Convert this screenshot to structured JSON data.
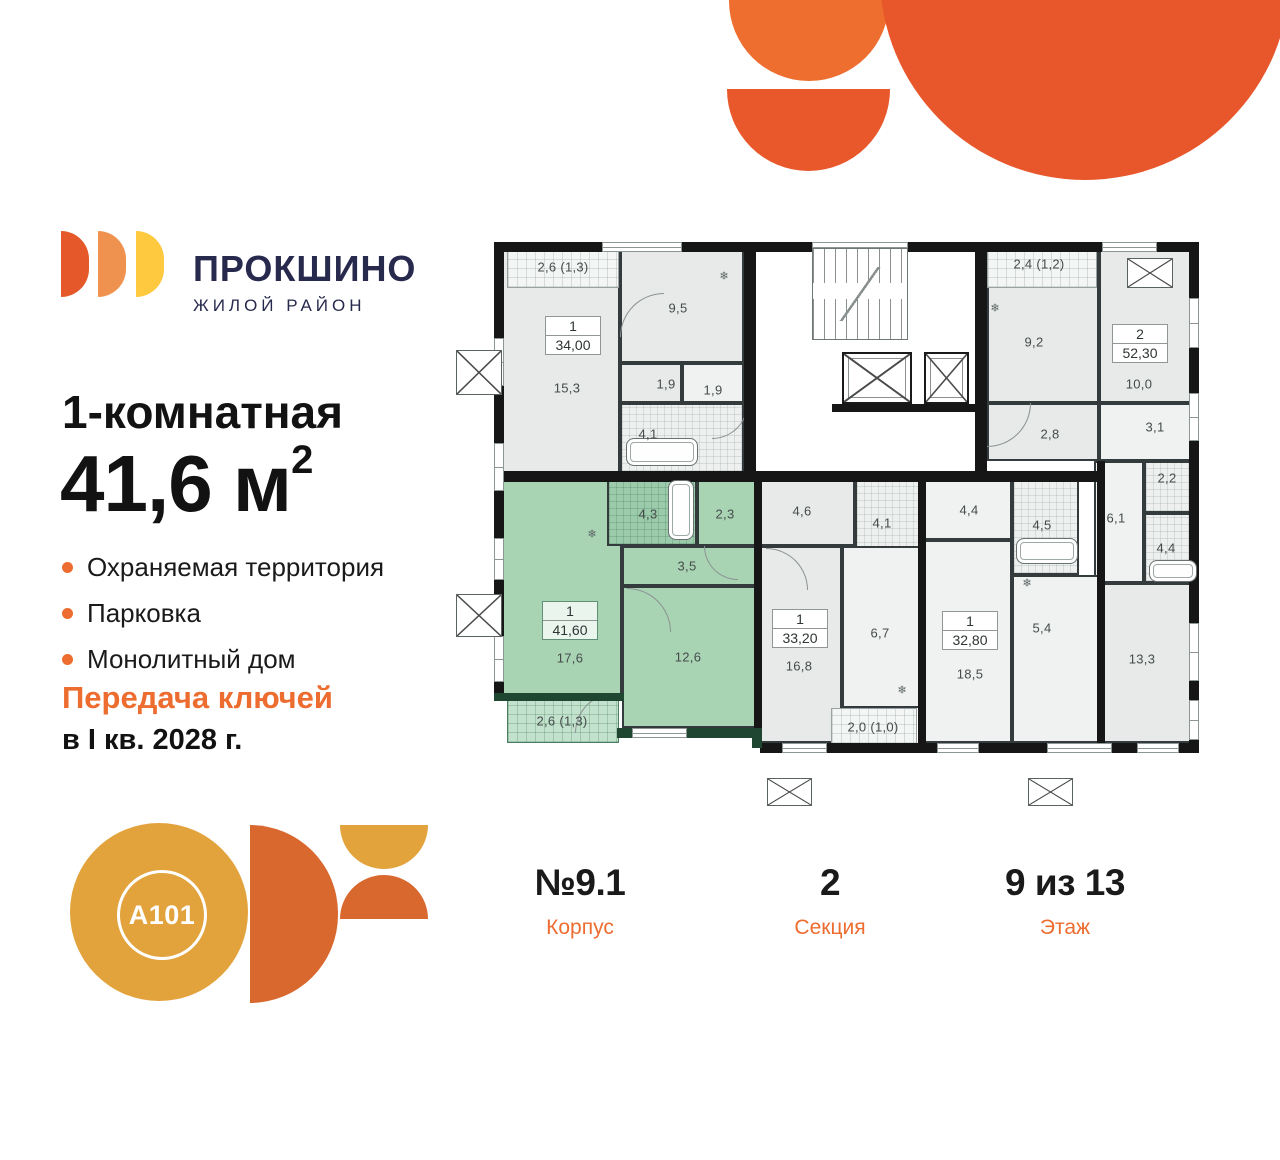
{
  "colors": {
    "accent_orange": "#ED6C2F",
    "deco_orange_light": "#ED6E2E",
    "deco_orange": "#E8572B",
    "navy": "#272A4D",
    "logo_arc1": "#E4582A",
    "logo_arc2": "#F0924F",
    "logo_arc3": "#FFC93F",
    "a101_gold": "#E2A33C",
    "a101_orange": "#D9682F",
    "plan_green": "#A9D4B4"
  },
  "brand": {
    "logo_title": "ПРОКШИНО",
    "logo_subtitle": "ЖИЛОЙ РАЙОН",
    "developer": "A101"
  },
  "offer": {
    "title": "1-комнатная",
    "area_value": "41,6",
    "area_unit": " м",
    "area_sup": "2",
    "features": [
      "Охраняемая территория",
      "Парковка",
      "Монолитный дом"
    ],
    "keys_line1": "Передача ключей",
    "keys_line2": "в I кв. 2028 г."
  },
  "footer": {
    "columns": [
      {
        "value": "№9.1",
        "label": "Корпус"
      },
      {
        "value": "2",
        "label": "Секция"
      },
      {
        "value": "9 из 13",
        "label": "Этаж"
      }
    ]
  },
  "plan": {
    "rooms": [
      [
        "g",
        20,
        12,
        118,
        238
      ],
      [
        "g",
        138,
        12,
        124,
        113
      ],
      [
        "g",
        138,
        125,
        62,
        40
      ],
      [
        "gl",
        200,
        125,
        62,
        40
      ],
      [
        "b",
        138,
        165,
        124,
        70
      ],
      [
        "bal",
        25,
        10,
        112,
        40
      ],
      [
        "g",
        505,
        12,
        112,
        153
      ],
      [
        "g",
        617,
        12,
        100,
        153
      ],
      [
        "g",
        505,
        165,
        112,
        58
      ],
      [
        "gl",
        617,
        165,
        100,
        58
      ],
      [
        "gl",
        612,
        223,
        50,
        122
      ],
      [
        "b",
        662,
        223,
        55,
        52
      ],
      [
        "b",
        662,
        275,
        55,
        70
      ],
      [
        "g",
        617,
        345,
        100,
        160
      ],
      [
        "bal",
        505,
        10,
        110,
        40
      ],
      [
        "gl",
        440,
        240,
        90,
        62
      ],
      [
        "b",
        530,
        240,
        67,
        97
      ],
      [
        "gl",
        440,
        302,
        90,
        203
      ],
      [
        "gl",
        530,
        337,
        88,
        168
      ],
      [
        "g",
        278,
        240,
        95,
        68
      ],
      [
        "b",
        373,
        240,
        67,
        95
      ],
      [
        "g",
        278,
        308,
        82,
        197
      ],
      [
        "gl",
        360,
        308,
        80,
        162
      ],
      [
        "bal",
        349,
        470,
        86,
        36
      ],
      [
        "gr",
        20,
        240,
        120,
        220
      ],
      [
        "bg",
        125,
        240,
        90,
        68
      ],
      [
        "gr",
        215,
        240,
        63,
        68
      ],
      [
        "gr",
        140,
        308,
        138,
        40
      ],
      [
        "gr",
        140,
        348,
        138,
        142
      ],
      [
        "balg",
        25,
        460,
        112,
        45
      ]
    ],
    "walls": [
      [
        12,
        4,
        705,
        10,
        0
      ],
      [
        12,
        4,
        10,
        459,
        0
      ],
      [
        707,
        4,
        10,
        511,
        0
      ],
      [
        262,
        4,
        12,
        236,
        0
      ],
      [
        493,
        4,
        12,
        236,
        0
      ],
      [
        350,
        166,
        143,
        8,
        0
      ],
      [
        12,
        233,
        608,
        11,
        0
      ],
      [
        272,
        240,
        8,
        265,
        0
      ],
      [
        436,
        240,
        8,
        265,
        0
      ],
      [
        615,
        223,
        8,
        282,
        0
      ],
      [
        278,
        505,
        439,
        10,
        0
      ],
      [
        12,
        455,
        130,
        8,
        1
      ],
      [
        135,
        490,
        143,
        10,
        1
      ],
      [
        270,
        490,
        10,
        20,
        1
      ]
    ],
    "windows": [
      [
        12,
        100,
        10,
        48
      ],
      [
        12,
        205,
        10,
        48
      ],
      [
        12,
        300,
        10,
        42
      ],
      [
        12,
        398,
        10,
        46
      ],
      [
        120,
        4,
        80,
        10
      ],
      [
        330,
        4,
        96,
        10
      ],
      [
        620,
        4,
        55,
        10
      ],
      [
        707,
        60,
        10,
        50
      ],
      [
        707,
        155,
        10,
        48
      ],
      [
        707,
        385,
        10,
        58
      ],
      [
        707,
        462,
        10,
        40
      ],
      [
        300,
        505,
        45,
        10
      ],
      [
        455,
        505,
        42,
        10
      ],
      [
        565,
        505,
        65,
        10
      ],
      [
        655,
        505,
        42,
        10
      ],
      [
        150,
        490,
        55,
        10
      ]
    ],
    "texts": [
      [
        "2,6 (1,3)",
        81,
        29
      ],
      [
        "9,5",
        196,
        70
      ],
      [
        "15,3",
        85,
        150
      ],
      [
        "1,9",
        184,
        146
      ],
      [
        "1,9",
        231,
        152
      ],
      [
        "4,1",
        166,
        196
      ],
      [
        "2,4 (1,2)",
        557,
        26
      ],
      [
        "9,2",
        552,
        104
      ],
      [
        "10,0",
        657,
        146
      ],
      [
        "2,8",
        568,
        196
      ],
      [
        "3,1",
        673,
        189
      ],
      [
        "2,2",
        685,
        240
      ],
      [
        "6,1",
        634,
        280
      ],
      [
        "4,4",
        684,
        310
      ],
      [
        "13,3",
        660,
        421
      ],
      [
        "4,4",
        487,
        272
      ],
      [
        "4,5",
        560,
        287
      ],
      [
        "5,4",
        560,
        390
      ],
      [
        "18,5",
        488,
        436
      ],
      [
        "4,6",
        320,
        273
      ],
      [
        "4,1",
        400,
        285
      ],
      [
        "6,7",
        398,
        395
      ],
      [
        "16,8",
        317,
        428
      ],
      [
        "2,0 (1,0)",
        391,
        489
      ],
      [
        "4,3",
        166,
        276
      ],
      [
        "2,3",
        243,
        276
      ],
      [
        "3,5",
        205,
        328
      ],
      [
        "17,6",
        88,
        420
      ],
      [
        "12,6",
        206,
        419
      ],
      [
        "2,6 (1,3)",
        80,
        483
      ]
    ],
    "badges": [
      [
        "1",
        "34,00",
        63,
        78,
        0
      ],
      [
        "2",
        "52,30",
        630,
        86,
        0
      ],
      [
        "1",
        "41,60",
        60,
        363,
        1
      ],
      [
        "1",
        "33,20",
        290,
        371,
        0
      ],
      [
        "1",
        "32,80",
        460,
        373,
        0
      ]
    ],
    "stairs": [
      330,
      10,
      96,
      92
    ],
    "elevators": [
      [
        360,
        114,
        70,
        52
      ],
      [
        442,
        114,
        45,
        52
      ]
    ],
    "vents": [
      [
        -26,
        112,
        46,
        45
      ],
      [
        -26,
        356,
        46,
        43
      ],
      [
        645,
        20,
        46,
        30
      ],
      [
        285,
        540,
        45,
        28
      ],
      [
        546,
        540,
        45,
        28
      ]
    ],
    "tubs": [
      [
        144,
        200,
        70,
        26
      ],
      [
        534,
        300,
        60,
        24
      ],
      [
        667,
        322,
        46,
        20
      ],
      [
        186,
        242,
        24,
        58
      ]
    ],
    "snowflakes": [
      [
        242,
        38
      ],
      [
        110,
        296
      ],
      [
        420,
        452
      ],
      [
        545,
        345
      ],
      [
        513,
        70
      ]
    ],
    "arcs": [
      [
        138,
        55,
        44,
        "tl"
      ],
      [
        145,
        350,
        44,
        "tr"
      ],
      [
        222,
        308,
        34,
        "bl"
      ],
      [
        284,
        310,
        42,
        "tr"
      ],
      [
        505,
        165,
        44,
        "br"
      ],
      [
        93,
        455,
        40,
        "tl"
      ],
      [
        230,
        165,
        36,
        "br"
      ]
    ]
  }
}
